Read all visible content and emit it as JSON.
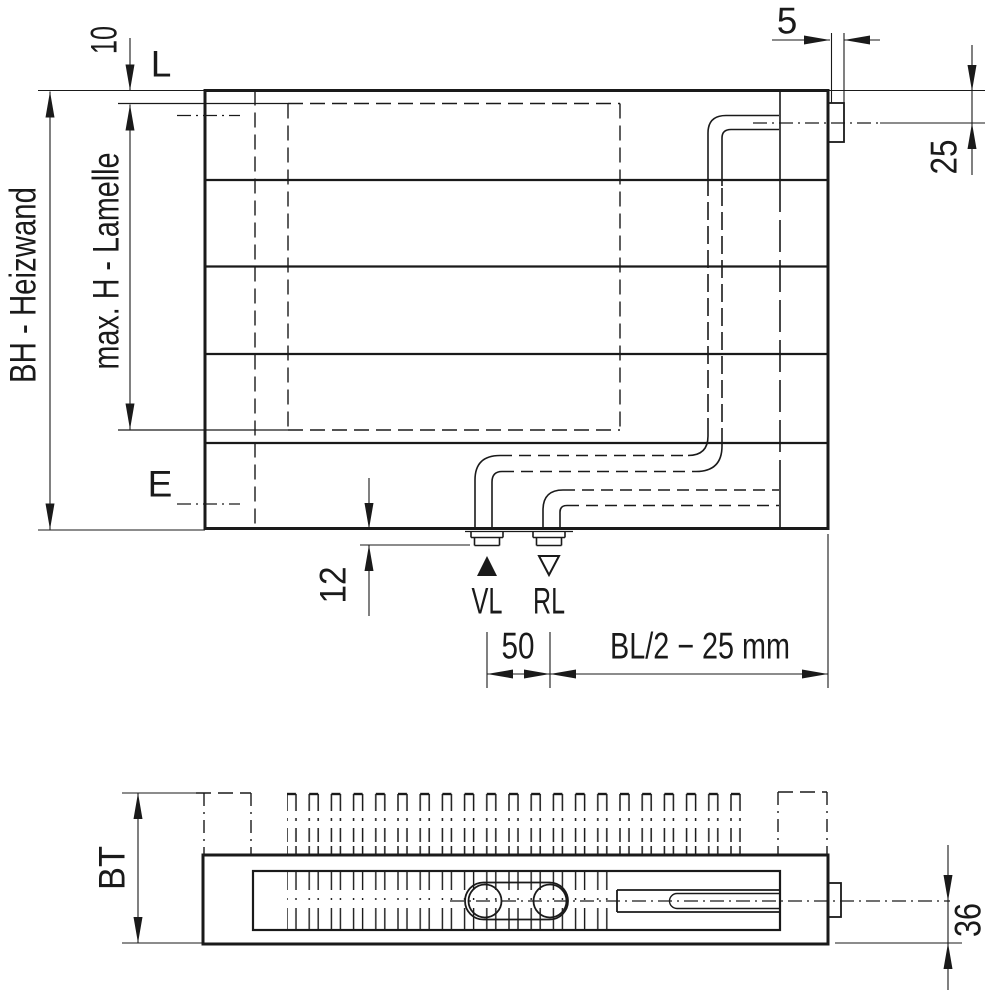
{
  "drawing": {
    "front_view": {
      "label_top_offset": "10",
      "label_vent": "L",
      "label_tab_width": "5",
      "label_tab_center": "25",
      "label_height": "BH - Heizwand",
      "label_fin_height": "max. H - Lamelle",
      "label_drain": "E",
      "label_stub_length": "12",
      "label_supply": "VL",
      "label_return": "RL",
      "label_spacing": "50",
      "label_half_length": "BL/2 − 25 mm"
    },
    "bottom_view": {
      "label_depth": "BT",
      "label_center_bottom": "36"
    },
    "colors": {
      "line": "#1a1a1a",
      "background": "#ffffff"
    }
  }
}
